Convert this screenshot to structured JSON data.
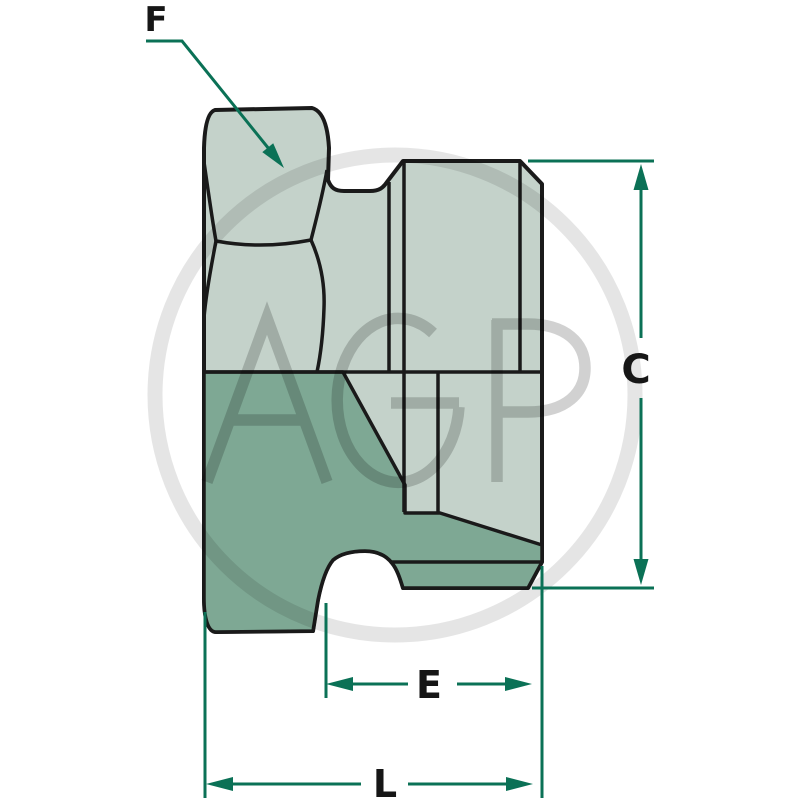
{
  "diagram": {
    "kind": "technical dimension drawing",
    "labels": {
      "f": "F",
      "c": "C",
      "e": "E",
      "l": "L"
    }
  },
  "watermark": {
    "text": "AGP"
  },
  "colors": {
    "part_light": "#c4d2ca",
    "part_dark": "#7ea894",
    "outline": "#1a1a1a",
    "dimension": "#0b7156",
    "background": "#ffffff"
  }
}
